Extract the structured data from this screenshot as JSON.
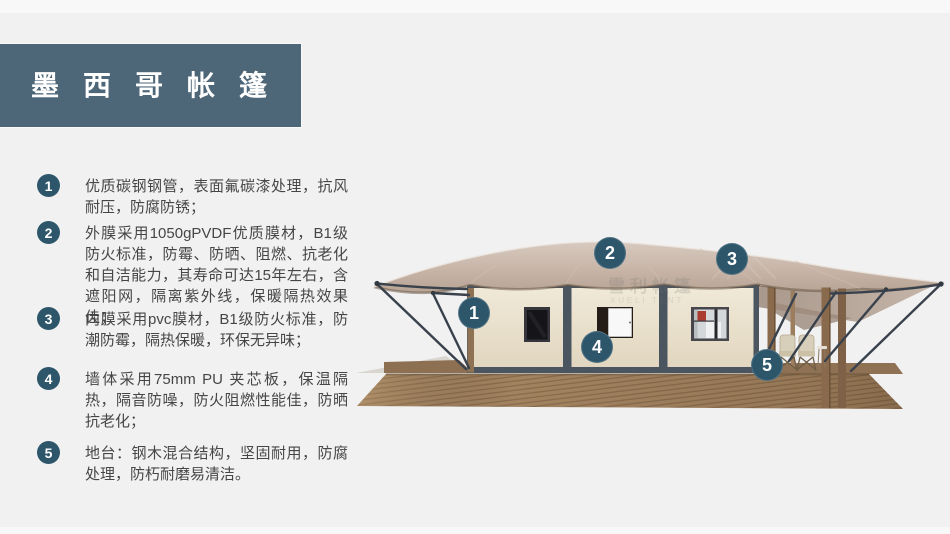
{
  "header": {
    "title": "墨西哥帐篷",
    "bg_color": "#4d6678",
    "text_color": "#ffffff"
  },
  "features": [
    {
      "num": "1",
      "text": "优质碳钢钢管，表面氟碳漆处理，抗风耐压，防腐防锈；"
    },
    {
      "num": "2",
      "text": "外膜采用1050gPVDF优质膜材，B1级防火标准，防霉、防晒、阻燃、抗老化和自洁能力，其寿命可达15年左右，含遮阳网，隔离紫外线，保暖隔热效果佳；"
    },
    {
      "num": "3",
      "text": "内膜采用pvc膜材，B1级防火标准，防潮防霉，隔热保暖，环保无异味；"
    },
    {
      "num": "4",
      "text": "墙体采用75mm PU 夹芯板，保温隔热，隔音防噪，防火阻燃性能佳，防晒抗老化；"
    },
    {
      "num": "5",
      "text": "地台：钢木混合结构，坚固耐用，防腐处理，防朽耐磨易清洁。"
    }
  ],
  "illustration": {
    "callouts": [
      {
        "label": "1"
      },
      {
        "label": "2"
      },
      {
        "label": "3"
      },
      {
        "label": "4"
      },
      {
        "label": "5"
      }
    ],
    "watermark": {
      "cn": "雪利帐篷",
      "en": "XUELI TENT"
    },
    "badge_color": "#2e566b"
  },
  "colors": {
    "page_bg": "#f1f1f2",
    "header_bg": "#4d6678",
    "badge": "#2e566b",
    "roof": "#c6b3a6",
    "wall": "#eae1cd",
    "deck_wood": "#a28360",
    "body_text": "#464646"
  }
}
